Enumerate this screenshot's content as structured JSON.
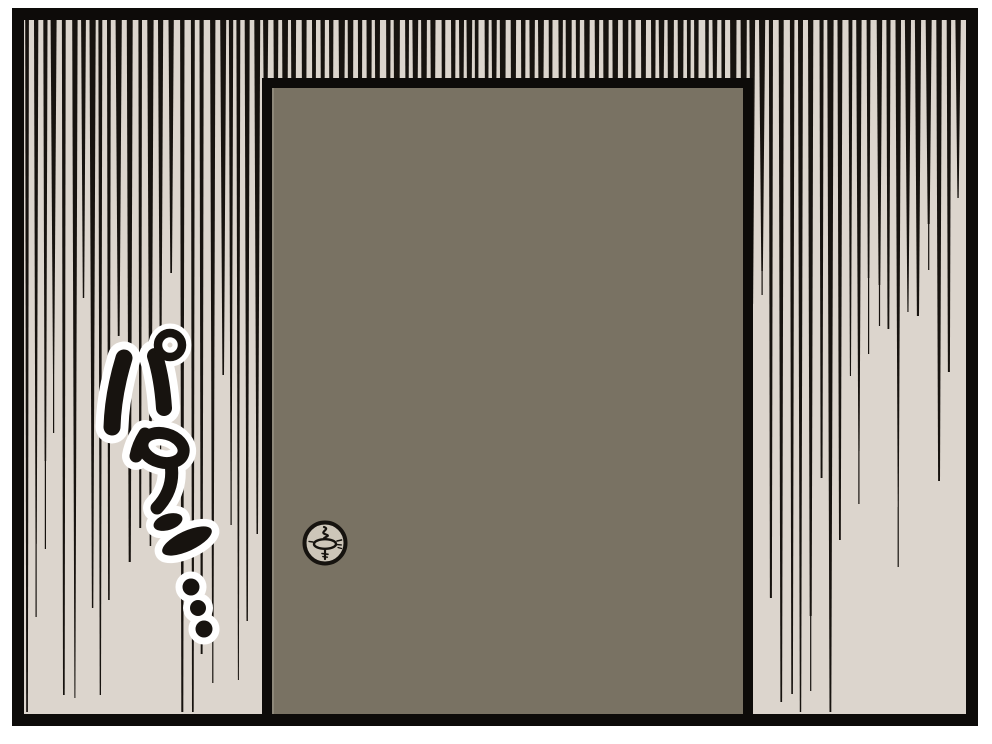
{
  "panel": {
    "kind": "manga-panel",
    "page_background": "#ffffff",
    "frame_color": "#0d0b09",
    "background": "#dcd5cd"
  },
  "speed_lines": {
    "color": "#17130f",
    "count": 110,
    "seed": 7
  },
  "door": {
    "fill": "#797263",
    "outline": "#0d0b09",
    "edge_highlight": "#8e887a"
  },
  "lock": {
    "face": "#cdc6b9",
    "outline": "#16130f"
  },
  "sfx": {
    "text": "パタン…",
    "color": "#17130f",
    "outline_color": "#ffffff"
  }
}
